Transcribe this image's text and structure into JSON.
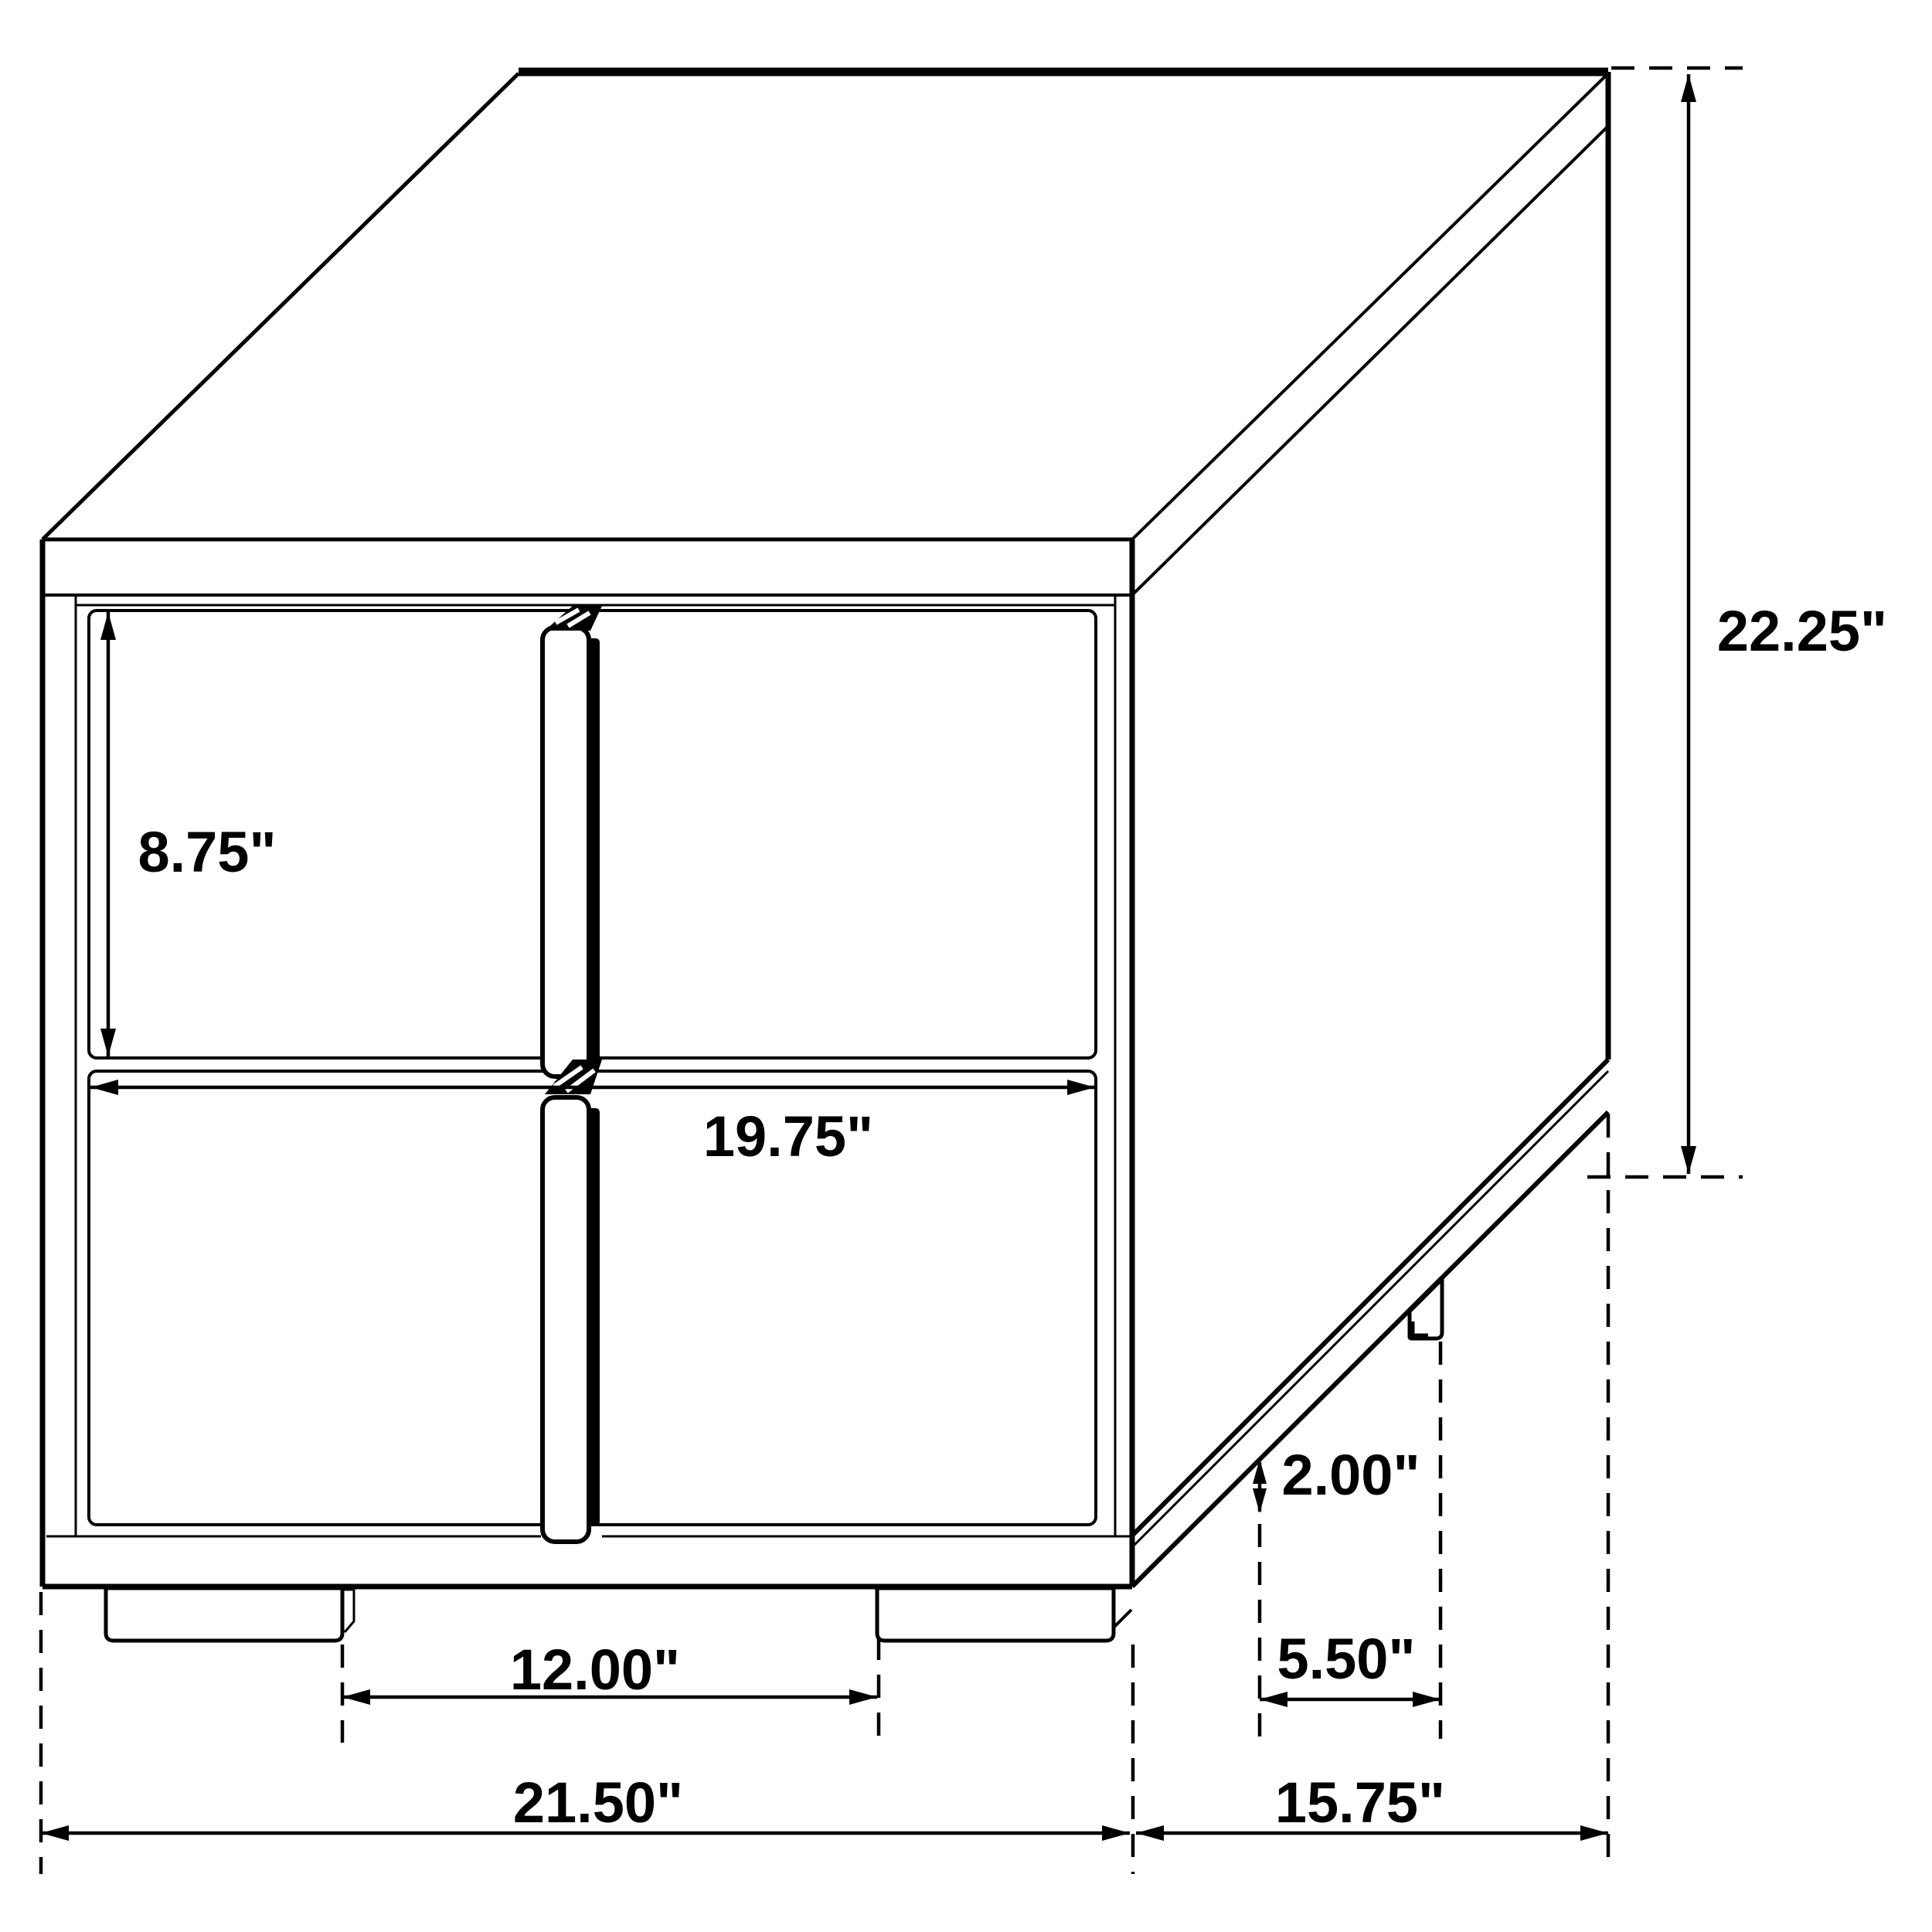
{
  "diagram": {
    "type": "furniture dimension drawing",
    "subject": "Two-drawer nightstand end table, perspective line drawing with dimension callouts",
    "units": "inches",
    "background_color": "#ffffff",
    "line_color": "#000000",
    "dimensions": {
      "overall_height": {
        "label": "22.25\"",
        "value": 22.25
      },
      "drawer_front_height": {
        "label": "8.75\"",
        "value": 8.75
      },
      "drawer_width": {
        "label": "19.75\"",
        "value": 19.75
      },
      "leg_height": {
        "label": "2.00\"",
        "value": 2.0
      },
      "front_leg_gap": {
        "label": "12.00\"",
        "value": 12.0
      },
      "side_leg_gap": {
        "label": "5.50\"",
        "value": 5.5
      },
      "overall_width": {
        "label": "21.50\"",
        "value": 21.5
      },
      "overall_depth": {
        "label": "15.75\"",
        "value": 15.75
      }
    }
  }
}
